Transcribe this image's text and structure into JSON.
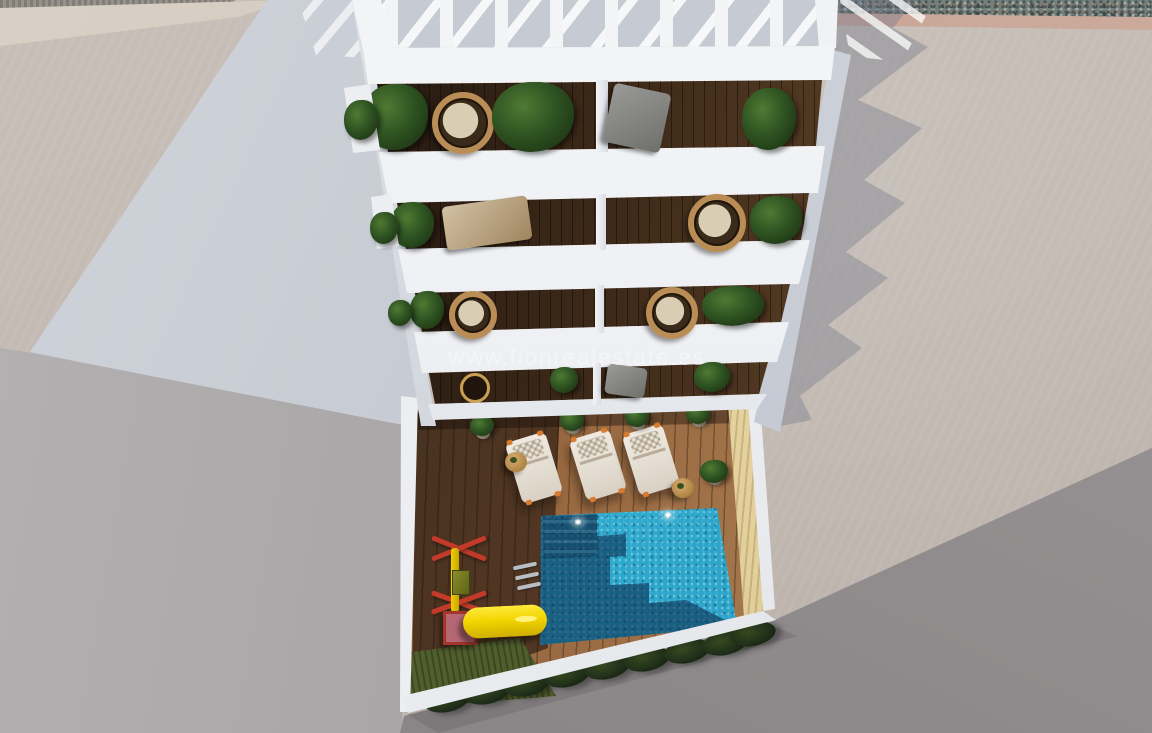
{
  "scene": {
    "description": "Aerial 3D architectural render: white apartment building with five stacked balcony floors and a rooftop pergola, above a courtyard with wooden deck, swimming pool, sun loungers and a children's playground",
    "watermark": "www.fionrealestate.es"
  },
  "colors": {
    "building_white": "#f2f3f6",
    "pool_water": "#2fb0d4",
    "pool_shadow": "#14517c",
    "deck_wood": "#96663f",
    "slide_yellow": "#f2d500",
    "frame_red": "#c23b2a",
    "hedge_green": "#20301a",
    "ground_beige": "#c2b9b2",
    "ground_gray": "#a7a3a4",
    "sand_wall": "#e0cc96",
    "accent_orange": "#d97b2e"
  },
  "counts": {
    "balcony_floors": 5,
    "balcony_units_per_floor": 2,
    "sun_loungers": 3,
    "side_tables": 2,
    "pool_lights": 2,
    "deck_potted_plants": 5,
    "hedge_bushes": 9
  }
}
